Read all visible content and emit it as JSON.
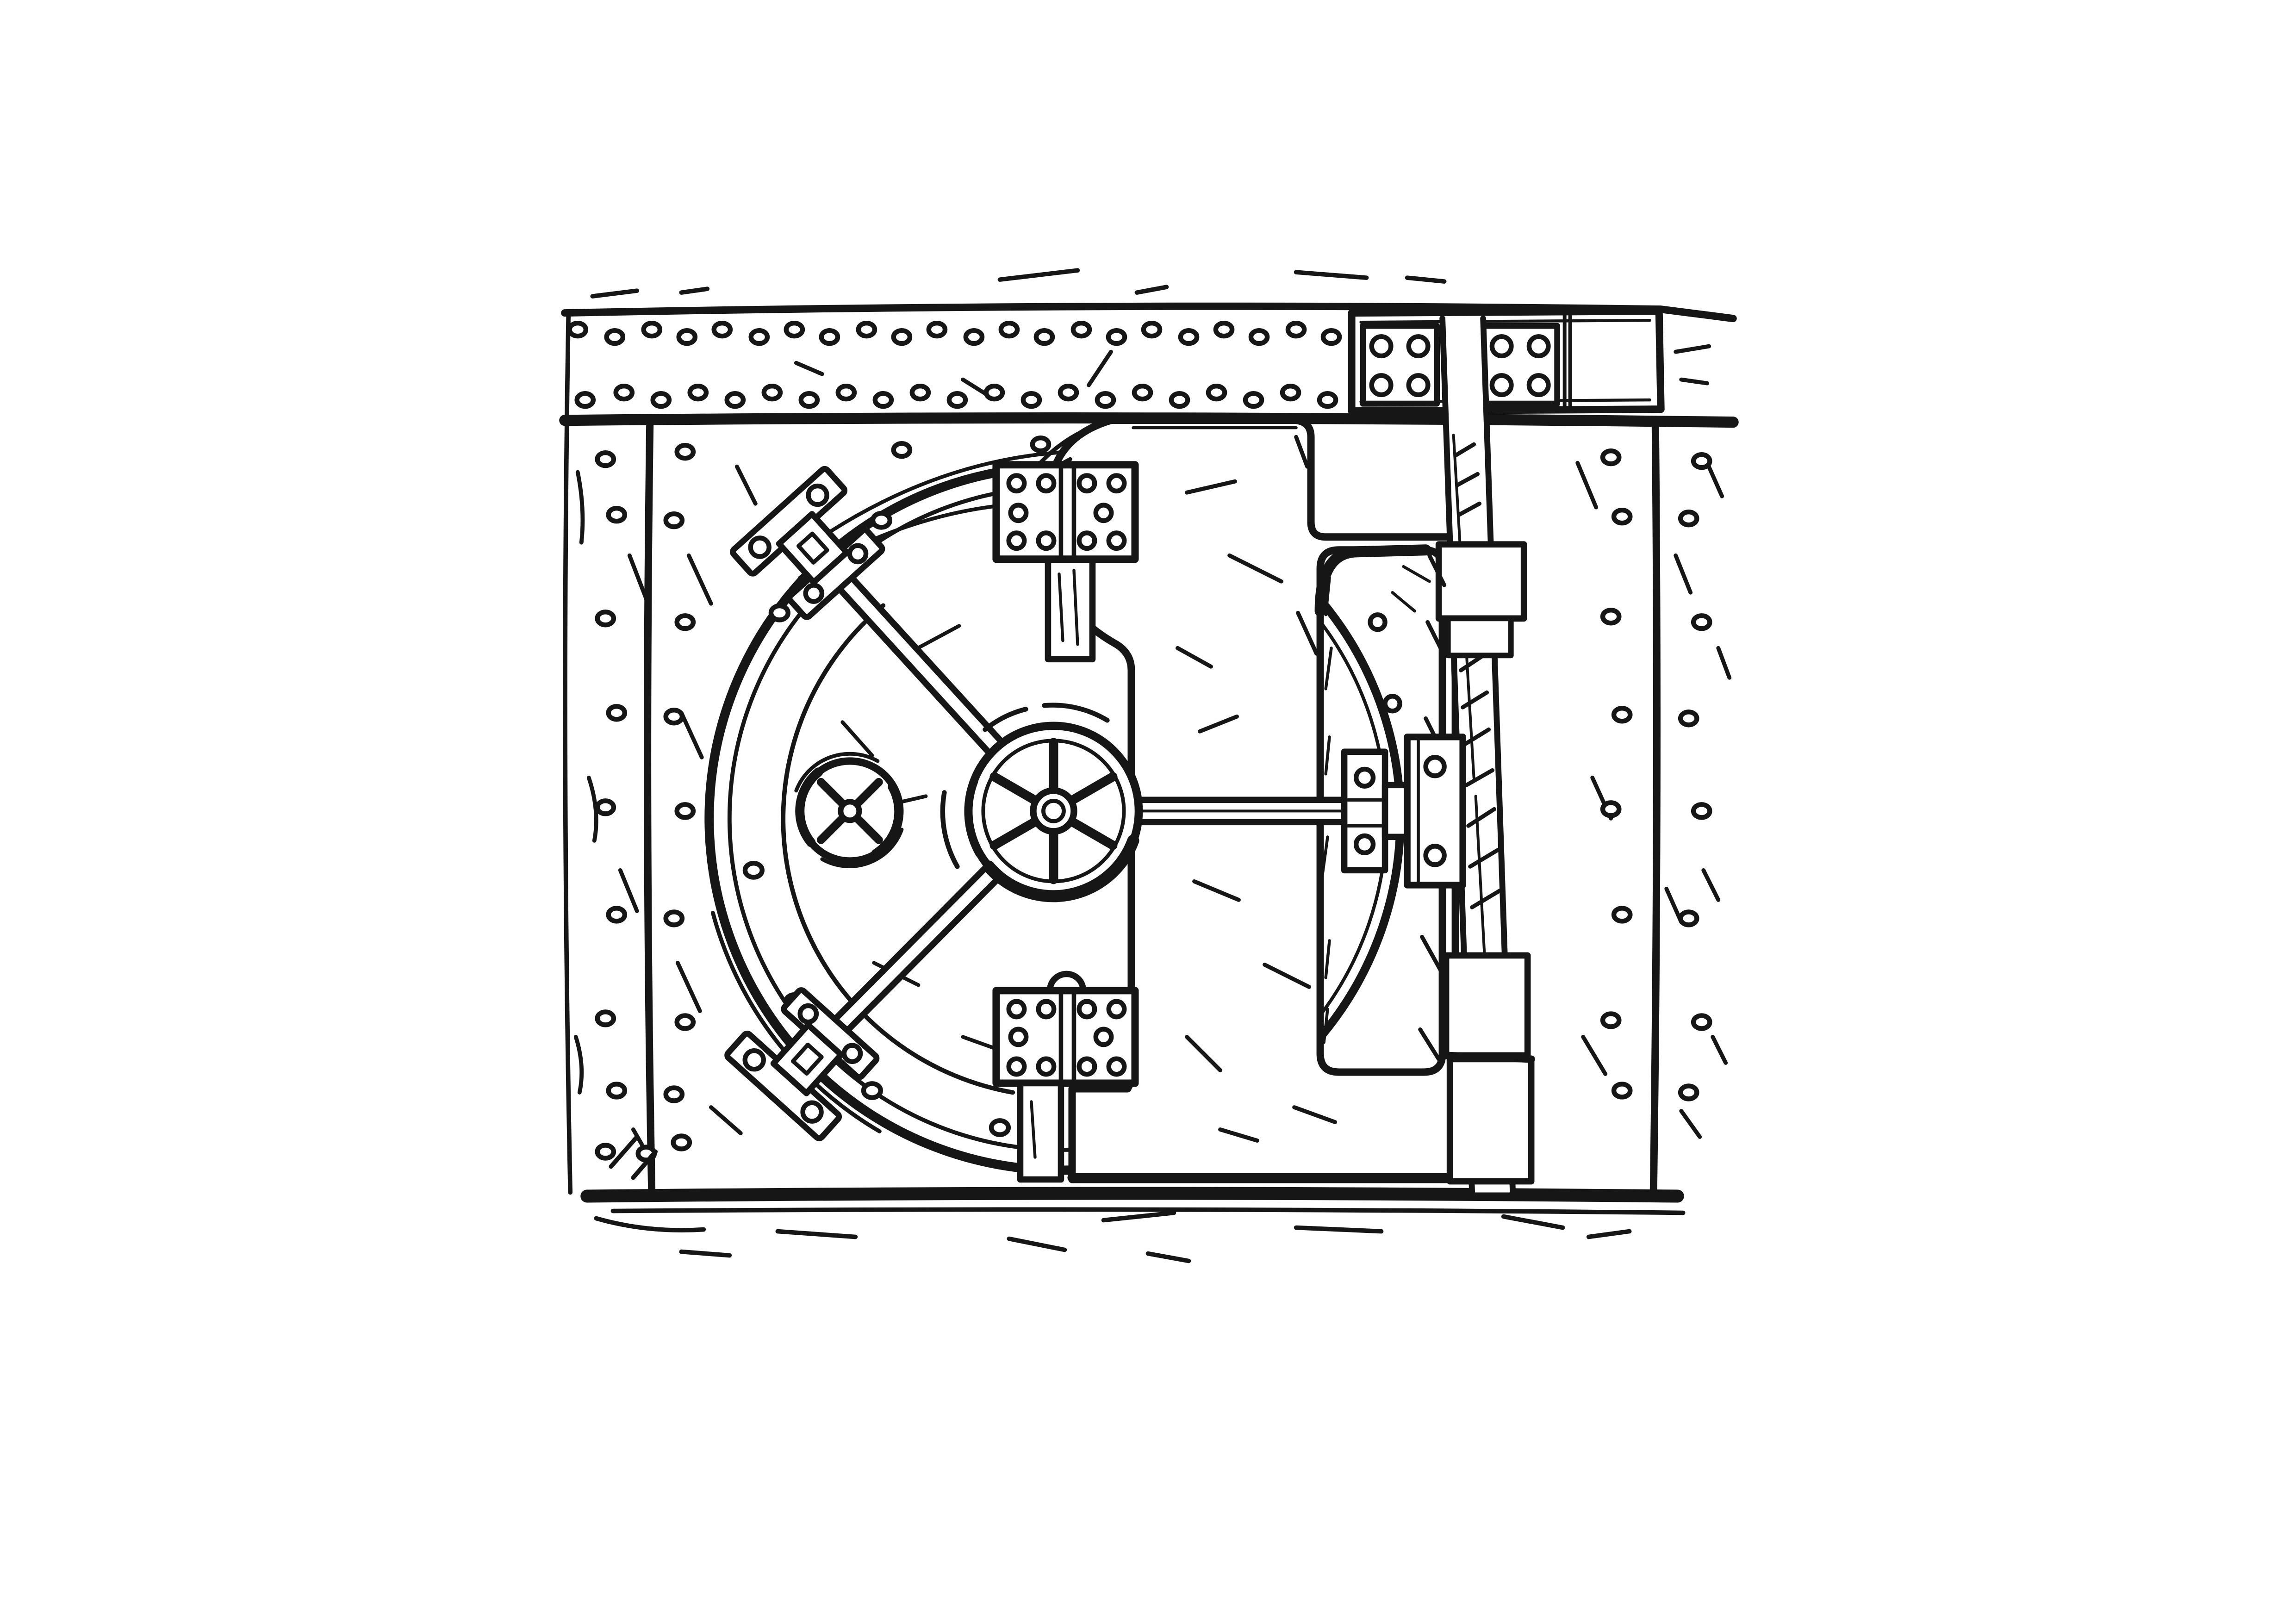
{
  "scene": {
    "title": "Hand-drawn black ink cartoon of a closed bank vault door with spoked handwheel, locking bars, hinges and riveted steel walls",
    "medium": "ink sketch, black on white",
    "ink_color": "#161616",
    "paper_color": "#ffffff",
    "objects": [
      {
        "name": "riveted-top-band",
        "description": "horizontal riveted steel band across the top with two bolted plates at the right"
      },
      {
        "name": "vault-frame",
        "description": "square riveted steel frame surrounding the vault door"
      },
      {
        "name": "circular-door",
        "description": "large circular vault door with double rim"
      },
      {
        "name": "hub-handwheel",
        "description": "central six-spoke locking handwheel"
      },
      {
        "name": "small-dial",
        "description": "small four-spoke dial left of the handwheel"
      },
      {
        "name": "locking-bars",
        "description": "two diagonal bars to rim clamps and one horizontal bar to the side latch"
      },
      {
        "name": "rim-clamps",
        "description": "bolted clamp assemblies where the bars meet the door rim"
      },
      {
        "name": "door-leaf",
        "description": "rectangular door leaf with stepped edge and recessed panel"
      },
      {
        "name": "hinges",
        "description": "two bolted double-leaf hinges joining the circular door to the leaf"
      },
      {
        "name": "hinge-column",
        "description": "vertical hinge column with bracket blocks on the right side"
      },
      {
        "name": "latch-assembly",
        "description": "bolted latch where the horizontal bar meets the jamb arc"
      }
    ],
    "counts": {
      "handwheel_spokes": 6,
      "dial_spokes": 4,
      "hinges": 2,
      "rim_clamps": 2,
      "top_plate_bolts_each": 4,
      "hinge_bolts_per_leaf": 5,
      "latch_bolts": 4
    }
  }
}
